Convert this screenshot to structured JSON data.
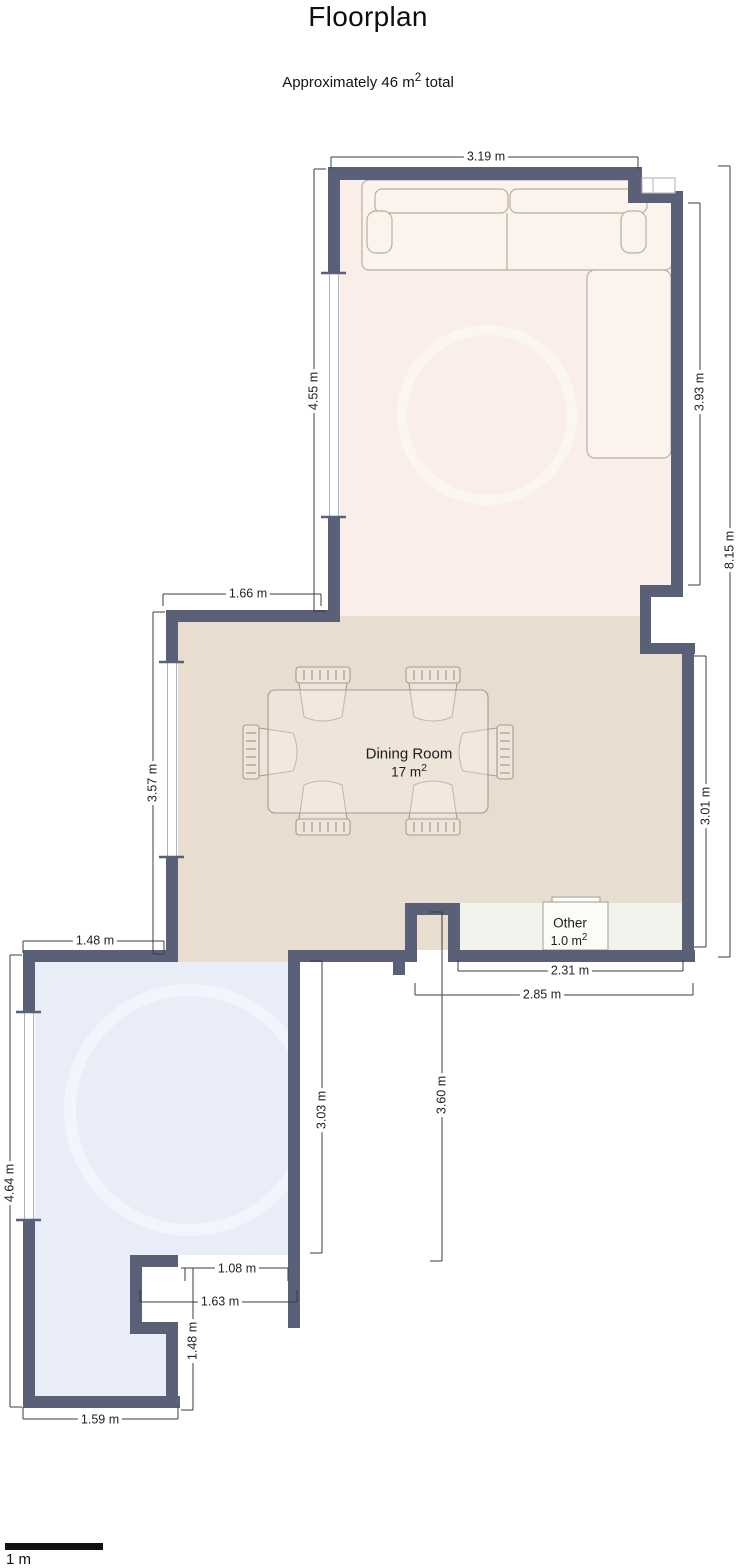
{
  "title": "Floorplan",
  "subtitle": {
    "prefix": "Approximately 46 m",
    "sup": "2",
    "suffix": " total"
  },
  "rooms": {
    "dining": {
      "name": "Dining Room",
      "area": "17 m",
      "area_sup": "2"
    },
    "other": {
      "name": "Other",
      "area": "1.0 m",
      "area_sup": "2"
    }
  },
  "dimensions": [
    {
      "id": "living-top-width",
      "label": "3.19 m",
      "orientation": "horizontal"
    },
    {
      "id": "living-left-height",
      "label": "4.55 m",
      "orientation": "vertical"
    },
    {
      "id": "living-right-height",
      "label": "3.93 m",
      "orientation": "vertical"
    },
    {
      "id": "total-right-height",
      "label": "8.15 m",
      "orientation": "vertical"
    },
    {
      "id": "dining-top-width",
      "label": "1.66 m",
      "orientation": "horizontal"
    },
    {
      "id": "dining-left-height",
      "label": "3.57 m",
      "orientation": "vertical"
    },
    {
      "id": "dining-right-height",
      "label": "3.01 m",
      "orientation": "vertical"
    },
    {
      "id": "bottom-room-top-width",
      "label": "1.48 m",
      "orientation": "horizontal"
    },
    {
      "id": "other-bottom-width",
      "label": "2.31 m",
      "orientation": "horizontal"
    },
    {
      "id": "bottom-outer-width",
      "label": "2.85 m",
      "orientation": "horizontal"
    },
    {
      "id": "hall-drop-height",
      "label": "3.60 m",
      "orientation": "vertical"
    },
    {
      "id": "bottom-room-left-height",
      "label": "4.64 m",
      "orientation": "vertical"
    },
    {
      "id": "bottom-room-right-height",
      "label": "3.03 m",
      "orientation": "vertical"
    },
    {
      "id": "entry-opening-width",
      "label": "1.08 m",
      "orientation": "horizontal"
    },
    {
      "id": "notch-width",
      "label": "1.63 m",
      "orientation": "horizontal"
    },
    {
      "id": "notch-height",
      "label": "1.48 m",
      "orientation": "vertical"
    },
    {
      "id": "bottom-room-bottom-width",
      "label": "1.59 m",
      "orientation": "horizontal"
    }
  ],
  "scale_bar": {
    "label": "1 m"
  },
  "colors": {
    "wall": "#5a6078",
    "living_room_floor": "#f9efe8",
    "dining_room_floor": "#e9ddd0",
    "other_floor": "#f2f2ec",
    "bottom_room_floor": "#e8edf8",
    "dimension_text": "#222222",
    "scale_bar": "#111111"
  }
}
